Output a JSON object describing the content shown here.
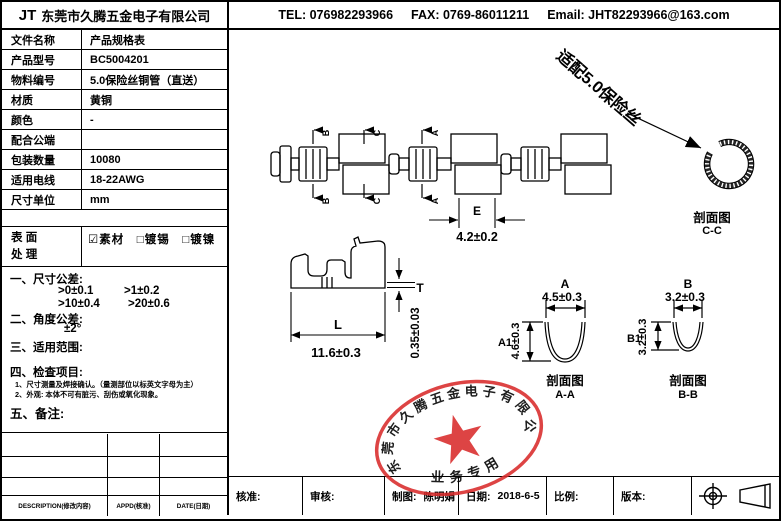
{
  "header": {
    "logo": "JT",
    "company": "东莞市久腾五金电子有限公司",
    "tel": "TEL: 076982293966",
    "fax": "FAX: 0769-86011211",
    "email": "Email: JHT82293966@163.com"
  },
  "spec_table": {
    "rows": [
      {
        "label": "文件名称",
        "value": "产品规格表"
      },
      {
        "label": "产品型号",
        "value": "BC5004201"
      },
      {
        "label": "物料编号",
        "value": "5.0保险丝铜管（直送）"
      },
      {
        "label": "材质",
        "value": "黄铜"
      },
      {
        "label": "颜色",
        "value": "-"
      },
      {
        "label": "配合公端",
        "value": ""
      },
      {
        "label": "包装数量",
        "value": "10080"
      },
      {
        "label": "适用电线",
        "value": "18-22AWG"
      },
      {
        "label": "尺寸单位",
        "value": "mm"
      }
    ],
    "surface": {
      "label1": "表 面",
      "label2": "处 理",
      "options": "☑素材　□镀锡　□镀镍"
    }
  },
  "tolerance_notes": {
    "h1": "一、尺寸公差:",
    "t1": ">0±0.1",
    "t2": ">1±0.2",
    "t3": ">10±0.4",
    "t4": ">20±0.6",
    "h2": "二、角度公差:",
    "angle": "±2°",
    "h3": "三、适用范围:",
    "h4": "四、检查项目:",
    "i1": "1、尺寸测量及焊接确认。（量测部位以标英文字母为主）",
    "i2": "2、外观: 本体不可有脏污、刮伤或氧化现象。",
    "h5": "五、备注:"
  },
  "revision_table": {
    "headers": [
      "DESCRIPTION(修改内容)",
      "APPD(核准)",
      "DATE(日期)"
    ]
  },
  "title_block": {
    "approve": "核准:",
    "review": "审核:",
    "draw_label": "制图:",
    "draw_value": "陈明娟",
    "date_label": "日期:",
    "date_value": "2018-6-5",
    "scale": "比例:",
    "version": "版本:"
  },
  "drawing": {
    "section_marks": {
      "b": "B",
      "c": "C",
      "a": "A"
    },
    "dim_e": {
      "label": "E",
      "value": "4.2±0.2"
    },
    "fit_note": "适配5.0保险丝",
    "section_cc": {
      "title": "剖面图",
      "name": "C-C"
    },
    "profile": {
      "l_label": "L",
      "l_value": "11.6±0.3",
      "t_label": "T",
      "t_value": "0.35±0.03"
    },
    "section_aa": {
      "w_label": "A",
      "w_value": "4.5±0.3",
      "h_label": "A1",
      "h_value": "4.6±0.3",
      "title": "剖面图",
      "name": "A-A"
    },
    "section_bb": {
      "w_label": "B",
      "w_value": "3.2±0.3",
      "h_label": "B1",
      "h_value": "3.2±0.3",
      "title": "剖面图",
      "name": "B-B"
    }
  },
  "stamp": {
    "company": "东莞市久腾五金电子有限公司",
    "caption": "业务专用",
    "color": "#d92b2b"
  }
}
